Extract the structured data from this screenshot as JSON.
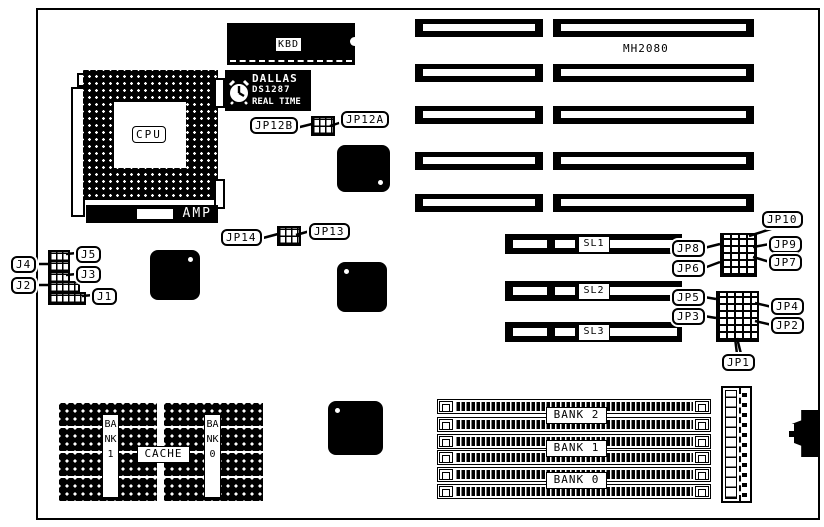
{
  "diagram": {
    "cpu_label": "CPU",
    "amp_label": "AMP",
    "kbd_label": "KBD",
    "rtc": {
      "brand": "DALLAS",
      "part": "DS1287",
      "type": "REAL TIME"
    },
    "chip_label": "MH2080",
    "slot_labels": {
      "sl1": "SL1",
      "sl2": "SL2",
      "sl3": "SL3"
    },
    "jumper_labels": {
      "jp1": "JP1",
      "jp2": "JP2",
      "jp3": "JP3",
      "jp4": "JP4",
      "jp5": "JP5",
      "jp6": "JP6",
      "jp7": "JP7",
      "jp8": "JP8",
      "jp9": "JP9",
      "jp10": "JP10",
      "jp12a": "JP12A",
      "jp12b": "JP12B",
      "jp13": "JP13",
      "jp14": "JP14"
    },
    "connector_labels": {
      "j1": "J1",
      "j2": "J2",
      "j3": "J3",
      "j4": "J4",
      "j5": "J5"
    },
    "memory_bank_labels": {
      "bank0": "BANK 0",
      "bank1": "BANK 1",
      "bank2": "BANK 2"
    },
    "cache": {
      "label": "CACHE",
      "bank0": "BANK0",
      "bank1": "BANK1"
    },
    "colors": {
      "ink": "#000000",
      "paper": "#ffffff"
    }
  }
}
